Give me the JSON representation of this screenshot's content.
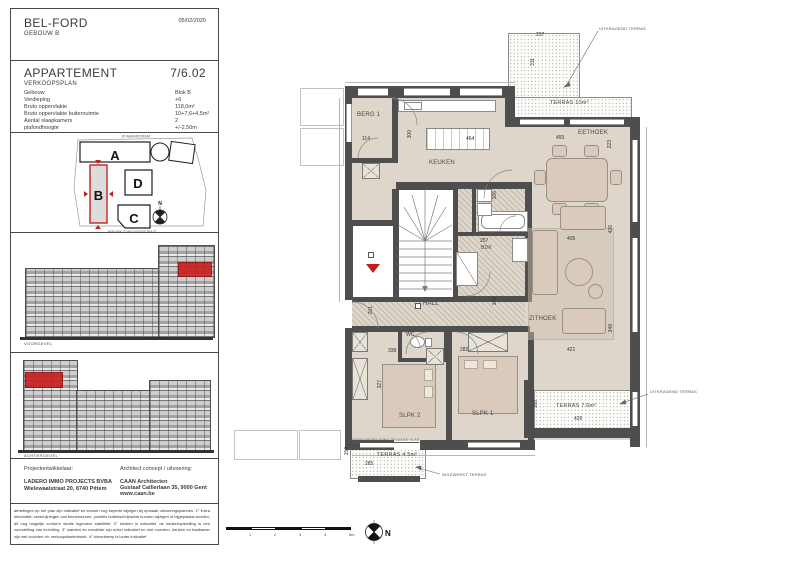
{
  "header": {
    "project": "BEL-FORD",
    "building": "GEBOUW B",
    "date": "05/02/2020"
  },
  "apartment": {
    "title": "APPARTEMENT",
    "subtitle": "VERKOOPSPLAN",
    "unit": "7/6.02"
  },
  "specs": {
    "rows": [
      {
        "label": "Gebouw",
        "value": "Blok B"
      },
      {
        "label": "Verdieping",
        "value": "+6"
      },
      {
        "label": "Bruto oppervlakte",
        "value": "118,0m²"
      },
      {
        "label": "Bruto oppervlakte buitenruimte",
        "value": "10+7,6+4,5m²"
      },
      {
        "label": "Aantal slaapkamers",
        "value": "2"
      },
      {
        "label": "plafondhoogte",
        "value": "+/-2,50m"
      }
    ]
  },
  "siteplan": {
    "street_top": "ST-AMANDSTRAAT",
    "street_bottom": "HENDRIK CONSCIENCESTRAAT",
    "blocks": {
      "a": "A",
      "b": "B",
      "c": "C",
      "d": "D"
    },
    "highlight_color": "#c42222"
  },
  "elevations": {
    "front_caption": "VOORGEVEL",
    "back_caption": "ACHTERGEVEL",
    "highlight_color": "#c92121"
  },
  "project": {
    "developer_label": "Projectontwikkelaar:",
    "developer_name": "LADERO IMMO PROJECTS BVBA",
    "developer_address": "Wielewaalstraat 20, 8740 Pittem",
    "architect_label": "Architect concept / uitvoering:",
    "architect_name": "CAAN Architecten",
    "architect_address": "Gustaaf Callierlaan 35, 9000 Gent",
    "architect_url": "www.caan.be"
  },
  "disclaimer": {
    "text": "afmetingen op het plan zijn indicatief en kunnen nog beperkt wijzigen bij opmaak uitvoeringsplannen.  1°  Extra informatie: verschijningen van binnenmuren, posities buitenschrijnwerk kunnen wijzigen of bijgeplaatst worden, dit nog mogelijk conform studie ingenieur stabiliteit.  2°  keuken is indicatief, de keukenopstelling is een voorstelling van inrichting.  3°  wanden en meubilair zijn enkel indicatief en niet voorzien, keuken en badkamer zijn wel voorzien cfr. verkoopslastenboek.  4°  tuinontwerp is louter indicatief"
  },
  "plan": {
    "rooms": {
      "berg1": "BERG 1",
      "keuken": "KEUKEN",
      "eethoek": "EETHOEK",
      "zithoek": "ZITHOEK",
      "berg2": "BERG 2",
      "bdk": "BDK",
      "hall": "HALL",
      "wc": "WC",
      "slpk1": "SLPK 1",
      "slpk2": "SLPK 2",
      "terras10": "TERRAS 10m²",
      "terras76": "TERRAS 7.6m²",
      "terras45": "TERRAS 4.5m²"
    },
    "dims": {
      "terras10_w": "237",
      "terras10_h": "311",
      "eethoek_w": "493",
      "eethoek_h": "223",
      "island_w": "464",
      "keuken_h": "300",
      "berg1_w": "114",
      "berg2_h": "106",
      "bdk_w": "257",
      "zithoek_w": "405",
      "zithoek_h": "426",
      "zithoek_w2": "421",
      "zithoek_h2": "348",
      "hall_h": "100",
      "hall_w": "201",
      "slpk2_w": "338",
      "slpk2_h": "327",
      "slpk1_w": "282",
      "terras76_w": "426",
      "terras76_h": "160",
      "terras45_w": "285",
      "terras45_h": "154"
    },
    "annotations": {
      "cantilever_terrace": "UITKRAGEND TERRAS",
      "cantilever_terrace2": "UITKRAGEND TERRAS",
      "recessed_terrace": "INGEWERKT TERRAS",
      "railing_note": "DOORVALBEVEILIGING GELAAGD GLAS"
    }
  },
  "legend": {
    "north": "N",
    "scale_ticks": [
      "1",
      "2",
      "3",
      "4",
      "5m"
    ]
  }
}
